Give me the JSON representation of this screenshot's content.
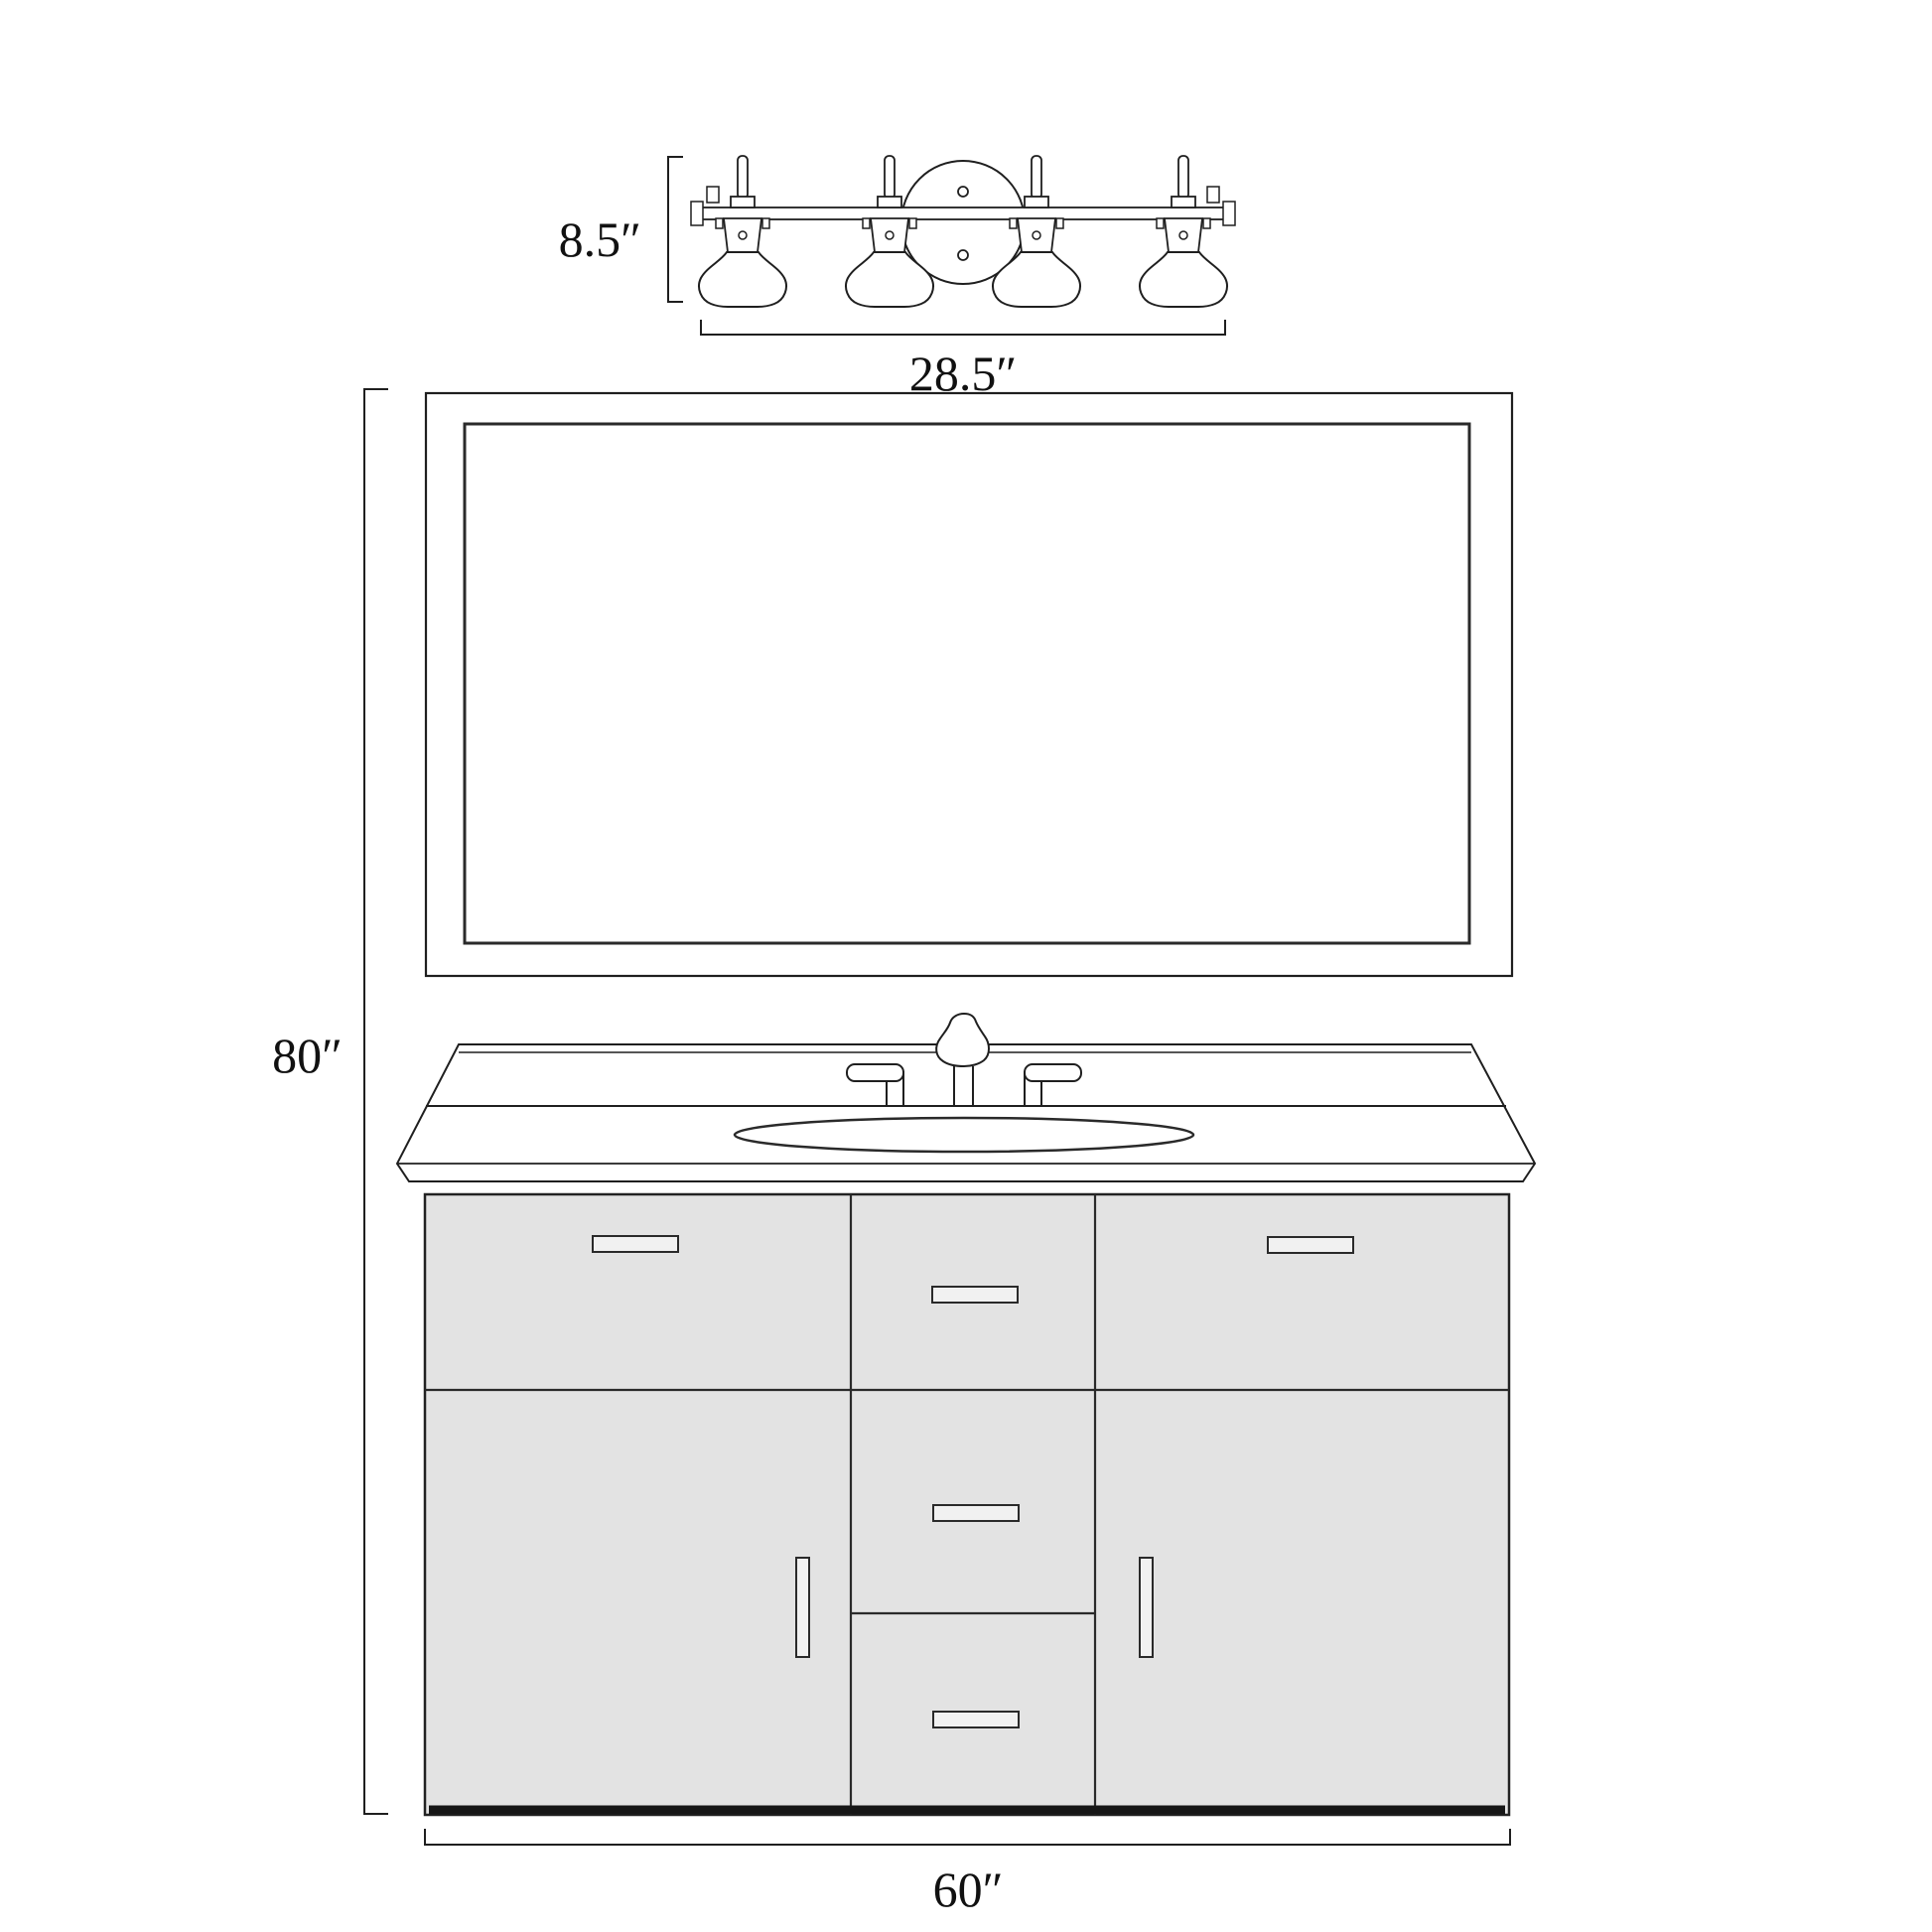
{
  "diagram": {
    "background": "#ffffff",
    "line_color": "#1f1f1f",
    "cabinet_fill": "#e3e3e3",
    "handle_fill": "#f1f1f1",
    "dimensions": {
      "light_height": "8.5″",
      "light_width": "28.5″",
      "overall_height": "80″",
      "vanity_width": "60″"
    },
    "components": {
      "light_fixture": "4-light vanity bar light",
      "mirror": "framed rectangular mirror",
      "countertop": "countertop with backsplash, oval sink and widespread faucet",
      "cabinet": "two-door vanity cabinet with center three-drawer bank"
    }
  }
}
